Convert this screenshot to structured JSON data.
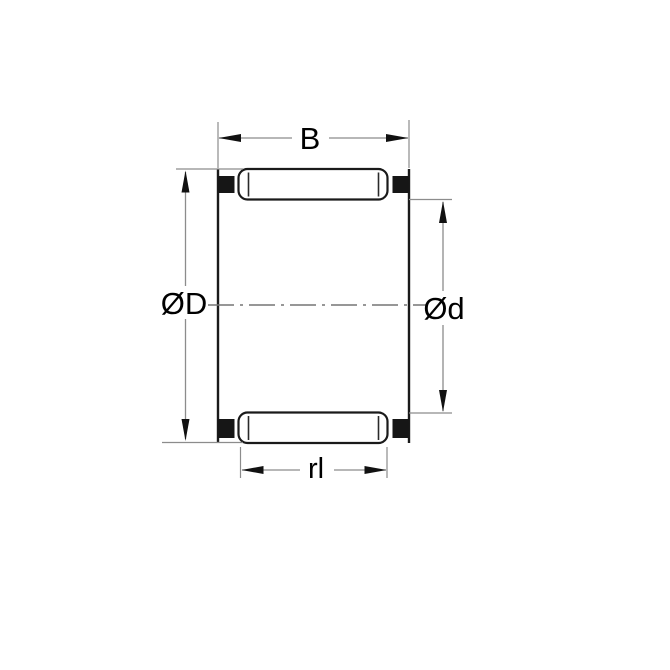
{
  "drawing": {
    "labels": {
      "width": "B",
      "outer_diameter": "ØD",
      "inner_diameter": "Ød",
      "roller_length": "rl"
    },
    "colors": {
      "outline": "#1a1a1a",
      "dimension_line": "#8c8c8c",
      "centerline": "#757575",
      "cage_fill": "#161616",
      "background": "#ffffff",
      "label_text": "#000000"
    }
  }
}
